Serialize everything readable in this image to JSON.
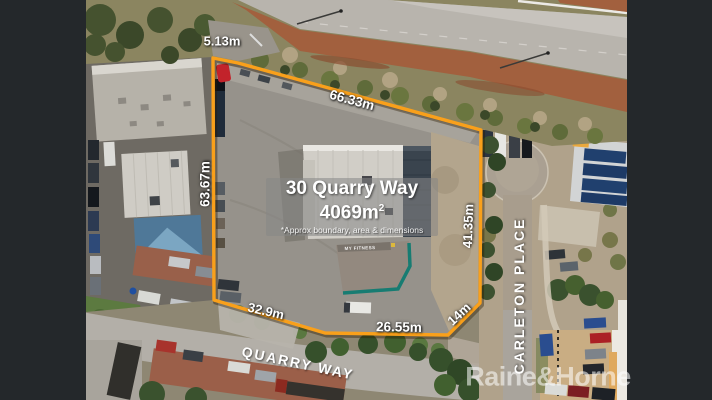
{
  "overlay": {
    "title": "30 Quarry Way",
    "area": "4069m",
    "area_sup": "2",
    "disclaimer": "*Approx boundary, area & dimensions"
  },
  "dimensions": {
    "top": "5.13m",
    "top_right": "66.33m",
    "left": "63.67m",
    "right": "41.35m",
    "bottom_diag": "14m",
    "bottom": "26.55m",
    "bottom_left": "32.9m"
  },
  "streets": {
    "quarry_way": "QUARRY WAY",
    "carleton_place": "CARLETON PLACE"
  },
  "building_sign": "MY FITNESS",
  "watermark": "Raine&Horne",
  "colors": {
    "boundary": "#F9A01B",
    "letterbox": "#24282B",
    "label_text": "#FFFFFF"
  }
}
